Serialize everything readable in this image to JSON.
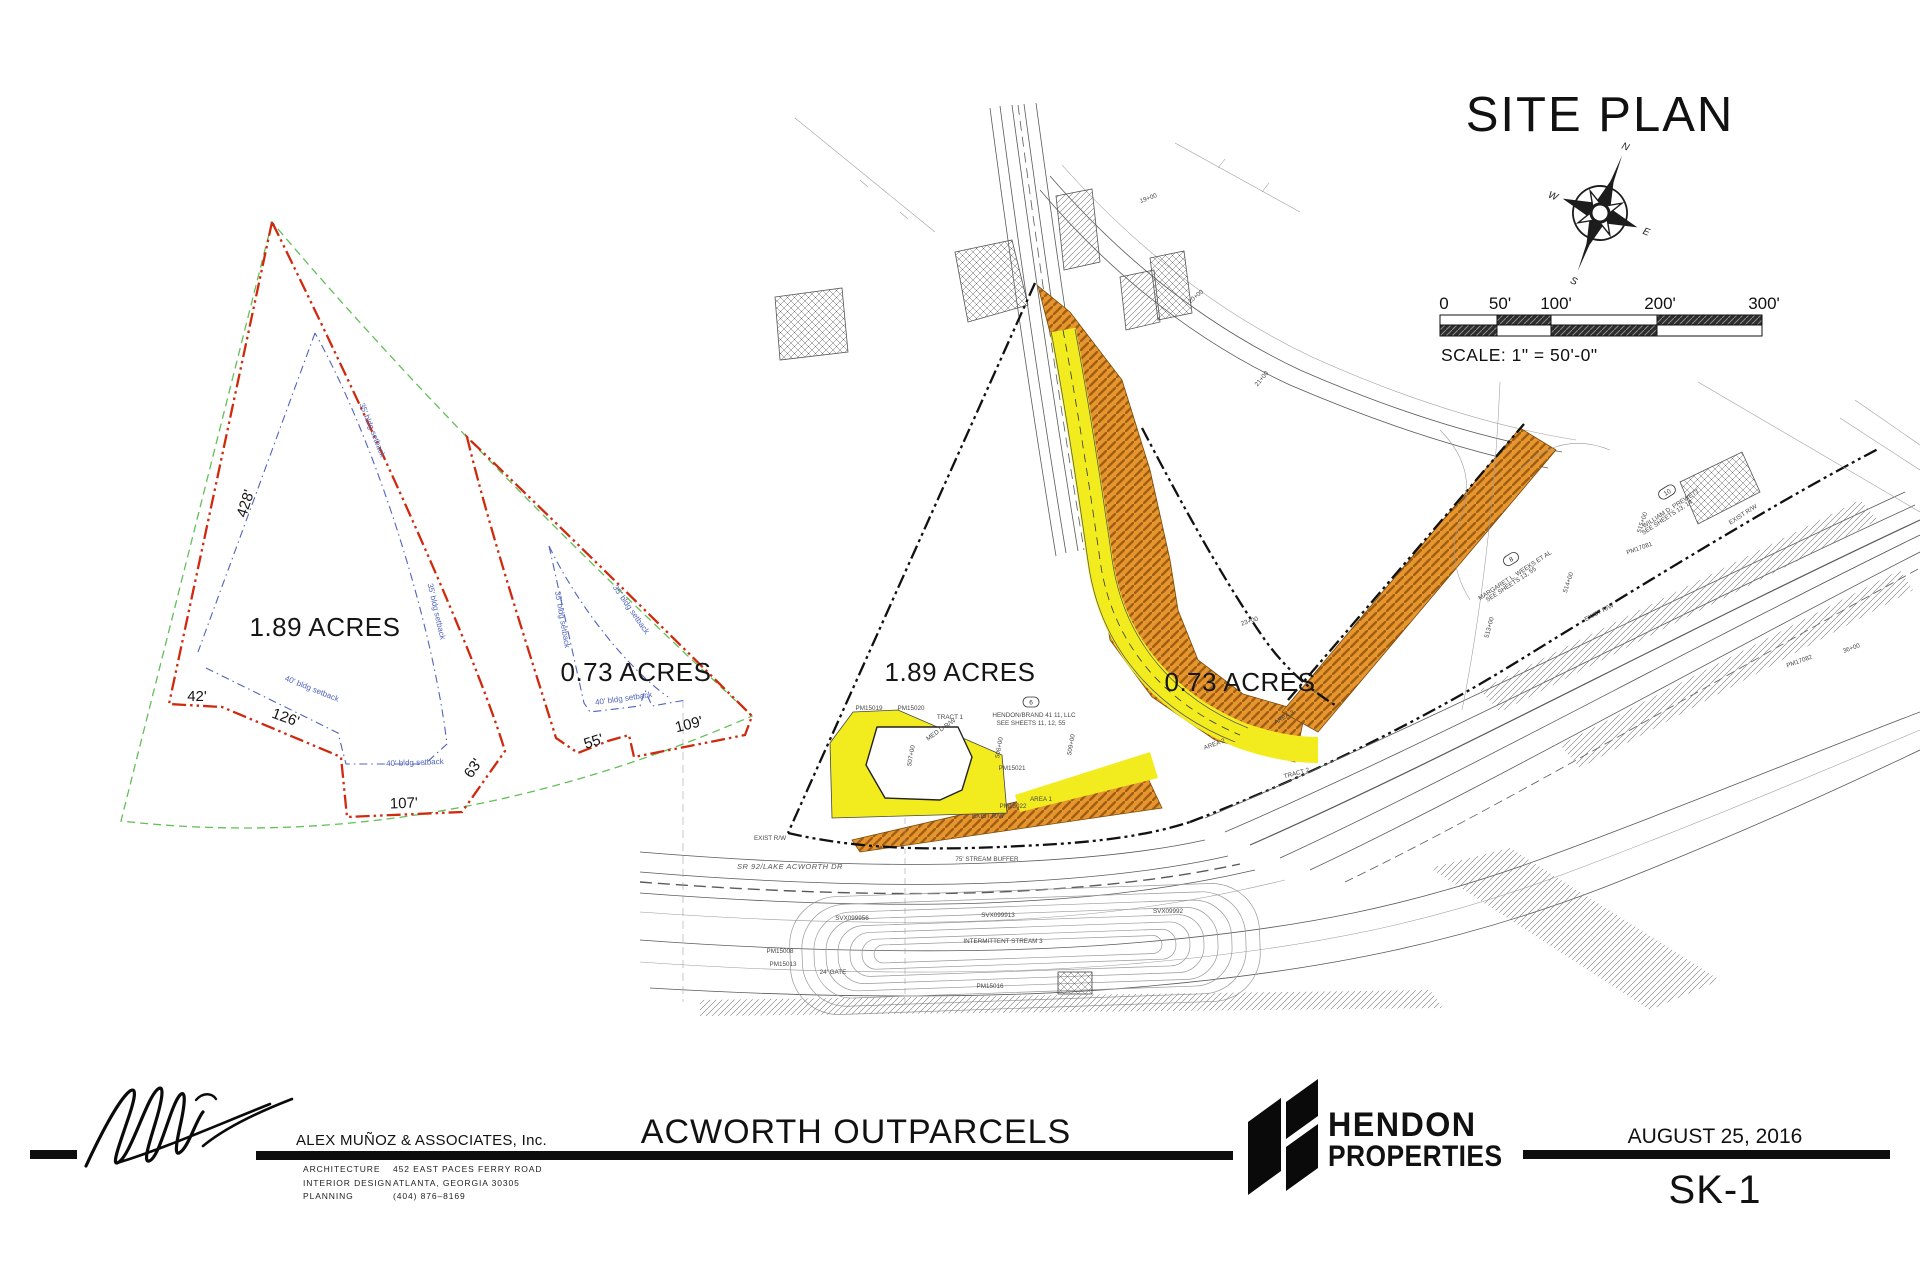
{
  "colors": {
    "yellow": "#f2ec1f",
    "orange": "#e6952f",
    "orange_hatch": "#a05f10",
    "red": "#cf2a0e",
    "green": "#63bf58",
    "blue": "#5064bd",
    "ink": "#1c1c1c"
  },
  "site_plan": {
    "heading": "SITE PLAN",
    "scale_text": "SCALE:  1\" = 50'-0\"",
    "scale_ticks": [
      "0",
      "50'",
      "100'",
      "200'",
      "300'"
    ],
    "compass": {
      "n": "N",
      "s": "S",
      "e": "E",
      "w": "W"
    }
  },
  "left_diagram": {
    "labels": [
      {
        "t": "428'",
        "x": 250,
        "y": 505,
        "r": -72,
        "c": "dim"
      },
      {
        "t": "42'",
        "x": 197,
        "y": 701,
        "r": 0,
        "c": "dim"
      },
      {
        "t": "126'",
        "x": 284,
        "y": 722,
        "r": 20,
        "c": "dim"
      },
      {
        "t": "107'",
        "x": 404,
        "y": 808,
        "r": -2,
        "c": "dim"
      },
      {
        "t": "63'",
        "x": 477,
        "y": 771,
        "r": -55,
        "c": "dim"
      },
      {
        "t": "55'",
        "x": 595,
        "y": 746,
        "r": -18,
        "c": "dim"
      },
      {
        "t": "109'",
        "x": 690,
        "y": 729,
        "r": -14,
        "c": "dim"
      },
      {
        "t": "1.89 ACRES",
        "x": 325,
        "y": 636,
        "r": 0,
        "c": "acres"
      },
      {
        "t": "0.73 ACRES",
        "x": 636,
        "y": 681,
        "r": 0,
        "c": "acres"
      },
      {
        "t": "35' bldg setback",
        "x": 370,
        "y": 431,
        "r": 68,
        "c": "sb"
      },
      {
        "t": "35' bldg setback",
        "x": 434,
        "y": 612,
        "r": 77,
        "c": "sb"
      },
      {
        "t": "40' bldg setback",
        "x": 311,
        "y": 691,
        "r": 22,
        "c": "sb"
      },
      {
        "t": "40' bldg setback",
        "x": 415,
        "y": 765,
        "r": -2,
        "c": "sb"
      },
      {
        "t": "35' bldg setback",
        "x": 560,
        "y": 620,
        "r": 80,
        "c": "sb"
      },
      {
        "t": "35' bldg setback",
        "x": 629,
        "y": 611,
        "r": 55,
        "c": "sb"
      },
      {
        "t": "40' bldg setback",
        "x": 624,
        "y": 701,
        "r": -8,
        "c": "sb"
      }
    ]
  },
  "right_plan": {
    "annotations": [
      {
        "t": "1.89 ACRES",
        "x": 960,
        "y": 681,
        "c": "acres"
      },
      {
        "t": "0.73 ACRES",
        "x": 1240,
        "y": 691,
        "c": "acres"
      },
      {
        "t": "TRACT 1",
        "x": 950,
        "y": 719
      },
      {
        "t": "MED D R/W",
        "x": 942,
        "y": 731,
        "r": -35
      },
      {
        "t": "507+00",
        "x": 913,
        "y": 756,
        "r": -80
      },
      {
        "t": "508+00",
        "x": 1001,
        "y": 748,
        "r": -80
      },
      {
        "t": "509+00",
        "x": 1073,
        "y": 745,
        "r": -80
      },
      {
        "t": "PM15019",
        "x": 869,
        "y": 710
      },
      {
        "t": "PM15020",
        "x": 911,
        "y": 710
      },
      {
        "t": "PM15021",
        "x": 1012,
        "y": 770
      },
      {
        "t": "PM15022",
        "x": 1013,
        "y": 808
      },
      {
        "t": "HENDON/BRAND 41 11, LLC",
        "x": 1034,
        "y": 717
      },
      {
        "t": "SEE SHEETS 11, 12, 55",
        "x": 1031,
        "y": 725
      },
      {
        "t": "AREA 1",
        "x": 1041,
        "y": 801
      },
      {
        "t": "AREA 2",
        "x": 1215,
        "y": 746,
        "r": -20
      },
      {
        "t": "AREA 3",
        "x": 1285,
        "y": 719,
        "r": -30
      },
      {
        "t": "23+00",
        "x": 1250,
        "y": 623,
        "r": -18
      },
      {
        "t": "EXIST R/W",
        "x": 988,
        "y": 818
      },
      {
        "t": "TRACT 2",
        "x": 1297,
        "y": 775,
        "r": -15
      },
      {
        "t": "SR 92/LAKE ACWORTH DR",
        "x": 790,
        "y": 869,
        "c": "roadname"
      },
      {
        "t": "75' STREAM BUFFER",
        "x": 987,
        "y": 861
      },
      {
        "t": "SVX099956",
        "x": 852,
        "y": 920
      },
      {
        "t": "SVX099913",
        "x": 998,
        "y": 917
      },
      {
        "t": "SVX09992",
        "x": 1168,
        "y": 913
      },
      {
        "t": "INTERMITTENT STREAM 3",
        "x": 1003,
        "y": 943
      },
      {
        "t": "PM15008",
        "x": 780,
        "y": 953
      },
      {
        "t": "PM15013",
        "x": 783,
        "y": 966
      },
      {
        "t": "PM15016",
        "x": 990,
        "y": 988
      },
      {
        "t": "24' GATE",
        "x": 833,
        "y": 974
      },
      {
        "t": "EXIST R/W",
        "x": 770,
        "y": 840
      },
      {
        "t": "513+00",
        "x": 1491,
        "y": 628,
        "r": -75
      },
      {
        "t": "514+00",
        "x": 1570,
        "y": 583,
        "r": -72
      },
      {
        "t": "515+00",
        "x": 1644,
        "y": 523,
        "r": -72
      },
      {
        "t": "MARGARET L. WEEKS ET AL",
        "x": 1516,
        "y": 577,
        "r": -33
      },
      {
        "t": "SEE SHEETS 13, 55",
        "x": 1512,
        "y": 586,
        "r": -33
      },
      {
        "t": "WILLIAM D. PREWETT",
        "x": 1672,
        "y": 510,
        "r": -33
      },
      {
        "t": "SEE SHEETS 13, 14",
        "x": 1668,
        "y": 519,
        "r": -33
      },
      {
        "t": "PM17081",
        "x": 1640,
        "y": 550,
        "r": -20
      },
      {
        "t": "PM17082",
        "x": 1800,
        "y": 663,
        "r": -20
      },
      {
        "t": "EXIST R/W",
        "x": 1600,
        "y": 614,
        "r": -28
      },
      {
        "t": "EXIST R/W",
        "x": 1744,
        "y": 516,
        "r": -33
      },
      {
        "t": "19+00",
        "x": 1149,
        "y": 200,
        "r": -20
      },
      {
        "t": "20+00",
        "x": 1197,
        "y": 298,
        "r": -40
      },
      {
        "t": "21+00",
        "x": 1263,
        "y": 380,
        "r": -50
      },
      {
        "t": "36+00",
        "x": 1852,
        "y": 650,
        "r": -20
      }
    ],
    "callouts": [
      {
        "label": "6"
      },
      {
        "label": "8"
      },
      {
        "label": "10"
      }
    ]
  },
  "titleblock": {
    "firm": "ALEX MUÑOZ & ASSOCIATES, Inc.",
    "services": [
      "ARCHITECTURE",
      "INTERIOR  DESIGN",
      "PLANNING"
    ],
    "address": [
      "452  EAST  PACES  FERRY  ROAD",
      "ATLANTA,  GEORGIA  30305",
      "(404)  876–8169"
    ],
    "project": "ACWORTH OUTPARCELS",
    "client_line1": "HENDON",
    "client_line2": "PROPERTIES",
    "date": "AUGUST 25, 2016",
    "sheet": "SK-1"
  }
}
